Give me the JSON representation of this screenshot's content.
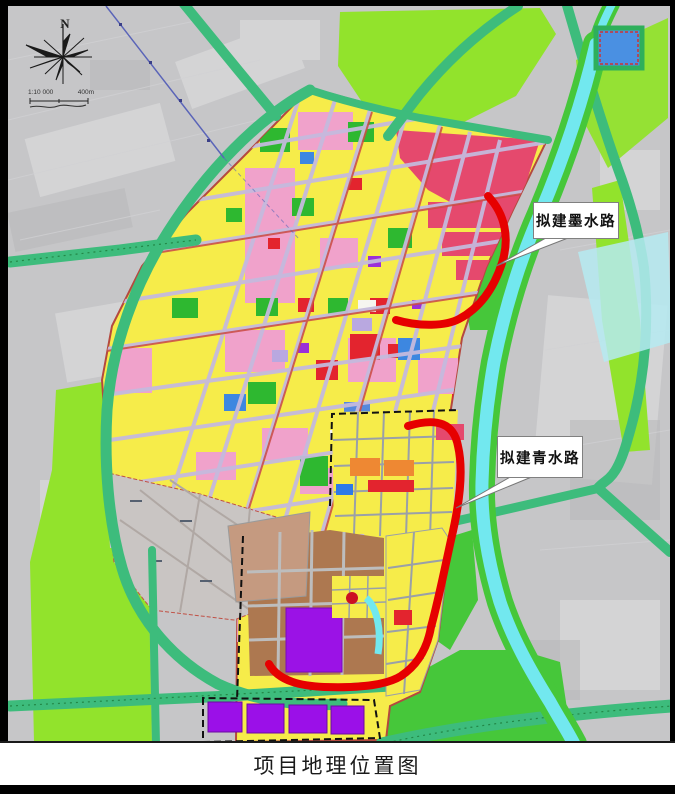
{
  "figure": {
    "caption": "项目地理位置图"
  },
  "map": {
    "compass_label": "N",
    "scale": {
      "ratio": "1:10 000",
      "distance": "400m"
    },
    "callouts": [
      {
        "label": "拟建墨水路"
      },
      {
        "label": "拟建青水路"
      }
    ],
    "legend_colors": {
      "proposed_road_red": "#e60000",
      "river_cyan": "#72e8ef",
      "road_green": "#3dbc7c",
      "farmland_lime": "#92e32c",
      "urban_yellow": "#f6ec4a",
      "residential_crimson": "#e5496d",
      "industrial_brown": "#ad7850",
      "special_use_purple": "#9b10e8",
      "rural_gray": "#c6c6c8"
    }
  }
}
